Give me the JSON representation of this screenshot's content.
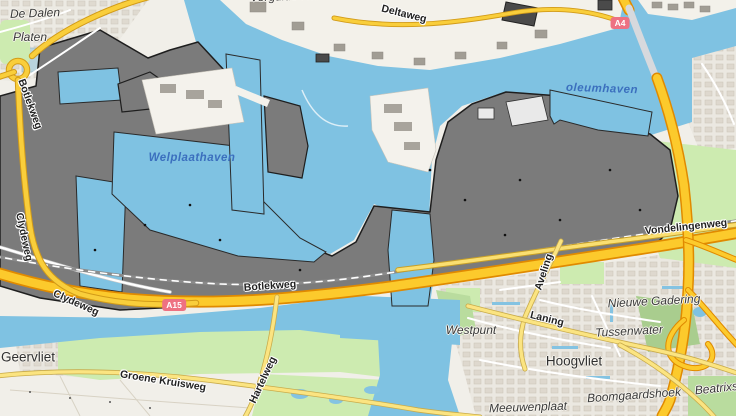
{
  "map": {
    "type": "street-map",
    "area": "Botlek / Vondelingenplaat / Hoogvliet (Rotterdam port area)",
    "colors": {
      "water": "#7fc2e2",
      "land": "#f1efe9",
      "industrial_fill": "#7b7b7b",
      "industrial_outline": "#1e1e1e",
      "green": "#cdebb0",
      "green_dark": "#a9cd8e",
      "residential": "#ebe8e1",
      "motorway_fill": "#fcca2c",
      "motorway_casing": "#e08a00",
      "secondary_fill": "#f9ce3b",
      "minor_road_fill": "#fbe481",
      "shield_background": "#ee7182",
      "water_label": "#3b6fbe"
    },
    "labels": [
      {
        "id": "label-de-dalen",
        "text": "De Dalen",
        "x": 35,
        "y": 13,
        "rot": -2,
        "cls": "lbl-suburb"
      },
      {
        "id": "label-platen",
        "text": "Platen",
        "x": 30,
        "y": 37,
        "rot": 0,
        "cls": "lbl-suburb"
      },
      {
        "id": "label-vergulde-hand",
        "text": "Vergulde Hand",
        "x": 290,
        "y": -4,
        "rot": -2,
        "cls": "lbl-suburb"
      },
      {
        "id": "label-deltaweg",
        "text": "Deltaweg",
        "x": 404,
        "y": 14,
        "rot": 14,
        "cls": "lbl-road"
      },
      {
        "id": "label-botlekweg-nw",
        "text": "Botlekweg",
        "x": 30,
        "y": 104,
        "rot": 70,
        "cls": "lbl-road"
      },
      {
        "id": "label-welplaathaven",
        "text": "Welplaathaven",
        "x": 192,
        "y": 158,
        "rot": 0,
        "cls": "lbl-water"
      },
      {
        "id": "label-petroleumhaven",
        "text": "oleumhaven",
        "x": 602,
        "y": 89,
        "rot": 2,
        "cls": "lbl-water"
      },
      {
        "id": "route-shield-a4",
        "text": "A4",
        "x": 620,
        "y": 23,
        "rot": 0,
        "cls": "lbl-shield"
      },
      {
        "id": "label-clydeweg-vertical",
        "text": "Clydeweg",
        "x": 24,
        "y": 237,
        "rot": 78,
        "cls": "lbl-road"
      },
      {
        "id": "label-clydeweg",
        "text": "Clydeweg",
        "x": 76,
        "y": 303,
        "rot": 24,
        "cls": "lbl-road"
      },
      {
        "id": "route-shield-a15",
        "text": "A15",
        "x": 174,
        "y": 305,
        "rot": 0,
        "cls": "lbl-shield"
      },
      {
        "id": "label-botlekweg",
        "text": "Botlekweg",
        "x": 270,
        "y": 286,
        "rot": -4,
        "cls": "lbl-road"
      },
      {
        "id": "label-vondelingenweg",
        "text": "Vondelingenweg",
        "x": 686,
        "y": 227,
        "rot": -6,
        "cls": "lbl-road"
      },
      {
        "id": "label-aveling",
        "text": "Aveling",
        "x": 544,
        "y": 272,
        "rot": -72,
        "cls": "lbl-road"
      },
      {
        "id": "label-laning",
        "text": "Laning",
        "x": 547,
        "y": 319,
        "rot": 14,
        "cls": "lbl-road"
      },
      {
        "id": "label-nieuwe-gadering",
        "text": "Nieuwe Gadering",
        "x": 654,
        "y": 301,
        "rot": -3,
        "cls": "lbl-suburb"
      },
      {
        "id": "label-westpunt",
        "text": "Westpunt",
        "x": 471,
        "y": 330,
        "rot": 0,
        "cls": "lbl-suburb"
      },
      {
        "id": "label-tussenwater",
        "text": "Tussenwater",
        "x": 629,
        "y": 331,
        "rot": -3,
        "cls": "lbl-suburb"
      },
      {
        "id": "label-hoogvliet",
        "text": "Hoogvliet",
        "x": 574,
        "y": 361,
        "rot": 0,
        "cls": "lbl-town"
      },
      {
        "id": "label-boomgaardshoek",
        "text": "Boomgaardshoek",
        "x": 634,
        "y": 395,
        "rot": -4,
        "cls": "lbl-suburb"
      },
      {
        "id": "label-beatrixst",
        "text": "Beatrixst",
        "x": 718,
        "y": 388,
        "rot": -6,
        "cls": "lbl-suburb"
      },
      {
        "id": "label-meeuwenplaat",
        "text": "Meeuwenplaat",
        "x": 528,
        "y": 407,
        "rot": -2,
        "cls": "lbl-suburb"
      },
      {
        "id": "label-geervliet",
        "text": "Geervliet",
        "x": 28,
        "y": 357,
        "rot": 0,
        "cls": "lbl-town"
      },
      {
        "id": "label-groene-kruisweg",
        "text": "Groene Kruisweg",
        "x": 163,
        "y": 381,
        "rot": 9,
        "cls": "lbl-road"
      },
      {
        "id": "label-hartelweg",
        "text": "Hartelweg",
        "x": 263,
        "y": 380,
        "rot": -65,
        "cls": "lbl-road"
      }
    ]
  }
}
